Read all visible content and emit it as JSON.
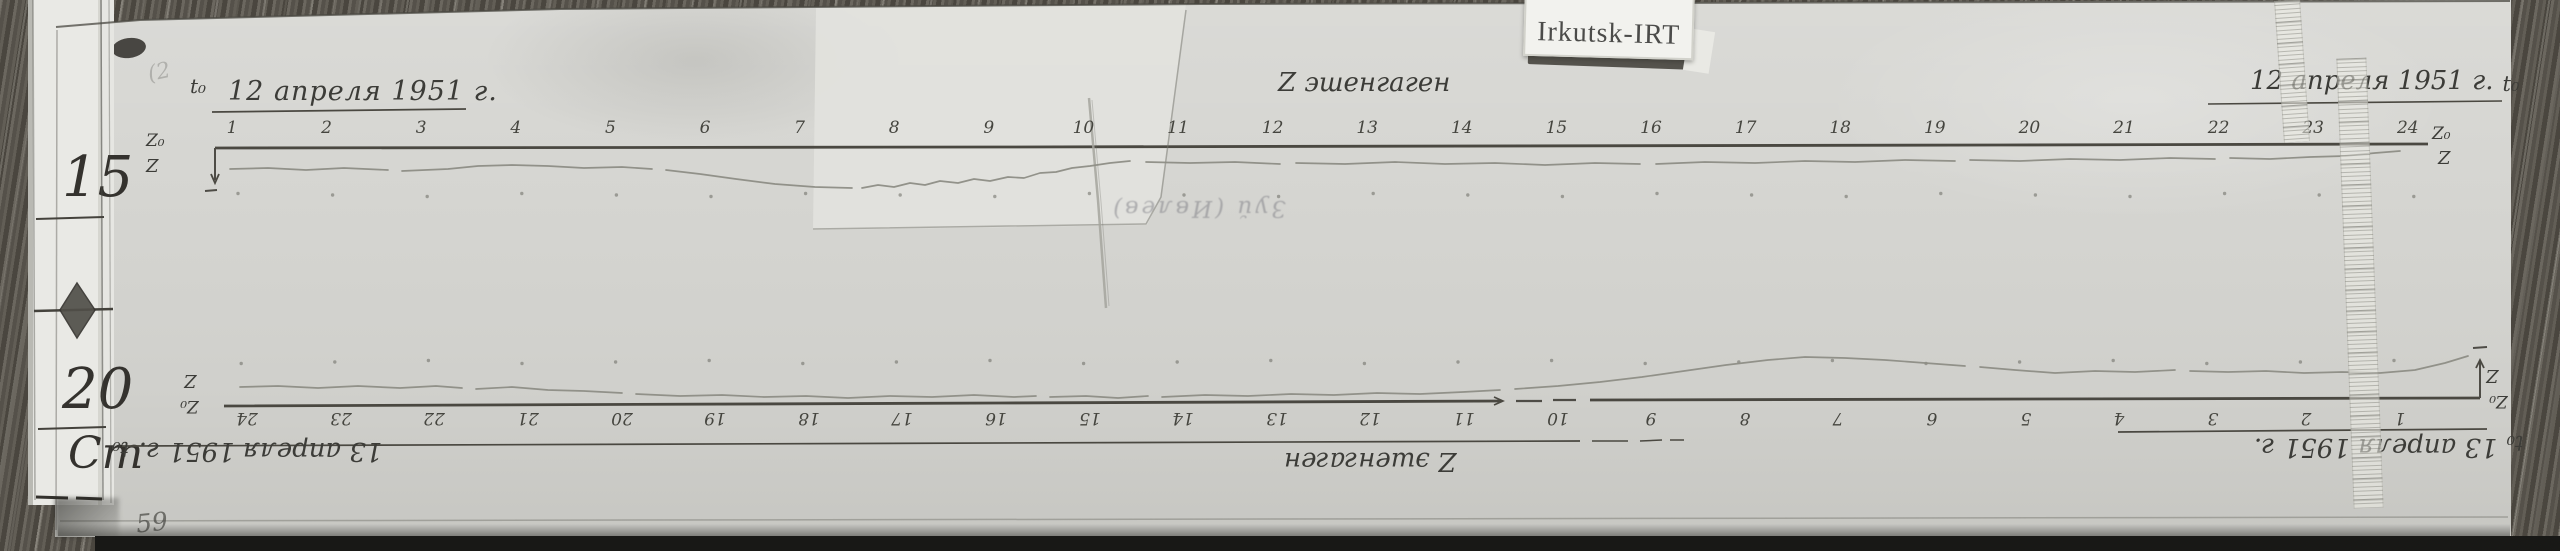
{
  "scan": {
    "side_ruler": {
      "mark_15": "15",
      "mark_20": "20",
      "unit_label": "Cm"
    },
    "station_card": {
      "text": "Irkutsk-IRT"
    },
    "corner_number": "59",
    "faint_note": "Зуй (Ивлев)",
    "scribble": "(2"
  },
  "top_record": {
    "t0_left": "t₀",
    "date_left": "12 апреля 1951 г.",
    "instrument_label": "Z эшенгаген",
    "date_right": "12 апреля 1951 г.",
    "t0_right": "t₀",
    "z0_label": "Z₀",
    "z_label": "Z",
    "hours": [
      "1",
      "2",
      "3",
      "4",
      "5",
      "6",
      "7",
      "8",
      "9",
      "10",
      "11",
      "12",
      "13",
      "14",
      "15",
      "16",
      "17",
      "18",
      "19",
      "20",
      "21",
      "22",
      "23",
      "24"
    ]
  },
  "bottom_record": {
    "date_left": "13 апреля 1951 г.",
    "t0_left": "t₀",
    "instrument_label": "Z эшенгаген",
    "t0_right": "t₀",
    "date_right": "13 апреля 1951 г.",
    "z0_label": "Z₀",
    "z_label": "Z",
    "hours": [
      "1",
      "2",
      "3",
      "4",
      "5",
      "6",
      "7",
      "8",
      "9",
      "10",
      "11",
      "12",
      "13",
      "14",
      "15",
      "16",
      "17",
      "18",
      "19",
      "20",
      "21",
      "22",
      "23",
      "24"
    ]
  },
  "traces": {
    "top": {
      "baseline": [
        [
          215,
          148
        ],
        [
          2428,
          144
        ]
      ],
      "segments": [
        [
          [
            230,
            169
          ],
          [
            268,
            168
          ],
          [
            306,
            170
          ],
          [
            344,
            168
          ],
          [
            388,
            170
          ]
        ],
        [
          [
            402,
            171
          ],
          [
            448,
            169
          ],
          [
            478,
            166
          ],
          [
            512,
            165
          ],
          [
            548,
            166
          ],
          [
            584,
            168
          ],
          [
            622,
            167
          ],
          [
            652,
            169
          ]
        ],
        [
          [
            666,
            170
          ],
          [
            700,
            174
          ],
          [
            736,
            179
          ],
          [
            775,
            184
          ],
          [
            815,
            187
          ],
          [
            852,
            188
          ]
        ],
        [
          [
            862,
            188
          ],
          [
            878,
            185
          ],
          [
            894,
            187
          ],
          [
            910,
            183
          ],
          [
            925,
            185
          ],
          [
            940,
            181
          ],
          [
            958,
            183
          ],
          [
            974,
            179
          ],
          [
            990,
            181
          ],
          [
            1008,
            177
          ],
          [
            1024,
            178
          ],
          [
            1040,
            173
          ],
          [
            1056,
            172
          ],
          [
            1072,
            168
          ],
          [
            1090,
            166
          ],
          [
            1110,
            163
          ],
          [
            1130,
            161
          ]
        ],
        [
          [
            1146,
            162
          ],
          [
            1190,
            163
          ],
          [
            1235,
            162
          ],
          [
            1280,
            164
          ]
        ],
        [
          [
            1296,
            163
          ],
          [
            1345,
            164
          ],
          [
            1395,
            162
          ],
          [
            1445,
            164
          ],
          [
            1495,
            163
          ],
          [
            1545,
            165
          ],
          [
            1595,
            163
          ],
          [
            1640,
            164
          ]
        ],
        [
          [
            1656,
            164
          ],
          [
            1705,
            162
          ],
          [
            1755,
            163
          ],
          [
            1805,
            161
          ],
          [
            1855,
            162
          ],
          [
            1905,
            160
          ],
          [
            1955,
            161
          ]
        ],
        [
          [
            1970,
            160
          ],
          [
            2020,
            161
          ],
          [
            2070,
            159
          ],
          [
            2120,
            160
          ],
          [
            2170,
            158
          ],
          [
            2215,
            159
          ]
        ],
        [
          [
            2230,
            158
          ],
          [
            2270,
            159
          ],
          [
            2310,
            157
          ],
          [
            2345,
            156
          ],
          [
            2375,
            153
          ],
          [
            2400,
            151
          ]
        ]
      ]
    },
    "bottom": {
      "baseline": [
        [
          224,
          406
        ],
        [
          2480,
          398
        ]
      ],
      "segments": [
        [
          [
            240,
            387
          ],
          [
            278,
            386
          ],
          [
            318,
            388
          ],
          [
            358,
            386
          ],
          [
            400,
            388
          ],
          [
            436,
            386
          ],
          [
            462,
            388
          ]
        ],
        [
          [
            476,
            389
          ],
          [
            512,
            387
          ],
          [
            548,
            390
          ],
          [
            584,
            391
          ],
          [
            622,
            393
          ]
        ],
        [
          [
            636,
            394
          ],
          [
            680,
            396
          ],
          [
            722,
            395
          ],
          [
            764,
            397
          ],
          [
            806,
            396
          ],
          [
            848,
            398
          ],
          [
            890,
            396
          ],
          [
            932,
            397
          ],
          [
            974,
            395
          ],
          [
            1014,
            397
          ],
          [
            1036,
            396
          ]
        ],
        [
          [
            1050,
            397
          ],
          [
            1086,
            396
          ],
          [
            1118,
            398
          ],
          [
            1148,
            396
          ]
        ],
        [
          [
            1162,
            397
          ],
          [
            1205,
            395
          ],
          [
            1248,
            396
          ],
          [
            1291,
            394
          ],
          [
            1334,
            395
          ],
          [
            1377,
            393
          ],
          [
            1420,
            394
          ],
          [
            1463,
            392
          ],
          [
            1500,
            390
          ]
        ],
        [
          [
            1515,
            389
          ],
          [
            1558,
            386
          ],
          [
            1600,
            382
          ],
          [
            1642,
            377
          ],
          [
            1684,
            371
          ],
          [
            1726,
            365
          ],
          [
            1768,
            360
          ],
          [
            1805,
            357
          ],
          [
            1845,
            358
          ],
          [
            1885,
            360
          ],
          [
            1925,
            363
          ],
          [
            1965,
            366
          ]
        ],
        [
          [
            1980,
            367
          ],
          [
            2015,
            370
          ],
          [
            2055,
            373
          ],
          [
            2095,
            371
          ],
          [
            2135,
            372
          ],
          [
            2175,
            370
          ]
        ],
        [
          [
            2190,
            371
          ],
          [
            2228,
            372
          ],
          [
            2266,
            371
          ],
          [
            2304,
            373
          ],
          [
            2342,
            372
          ],
          [
            2380,
            373
          ],
          [
            2415,
            370
          ],
          [
            2445,
            363
          ],
          [
            2468,
            356
          ]
        ]
      ]
    }
  }
}
